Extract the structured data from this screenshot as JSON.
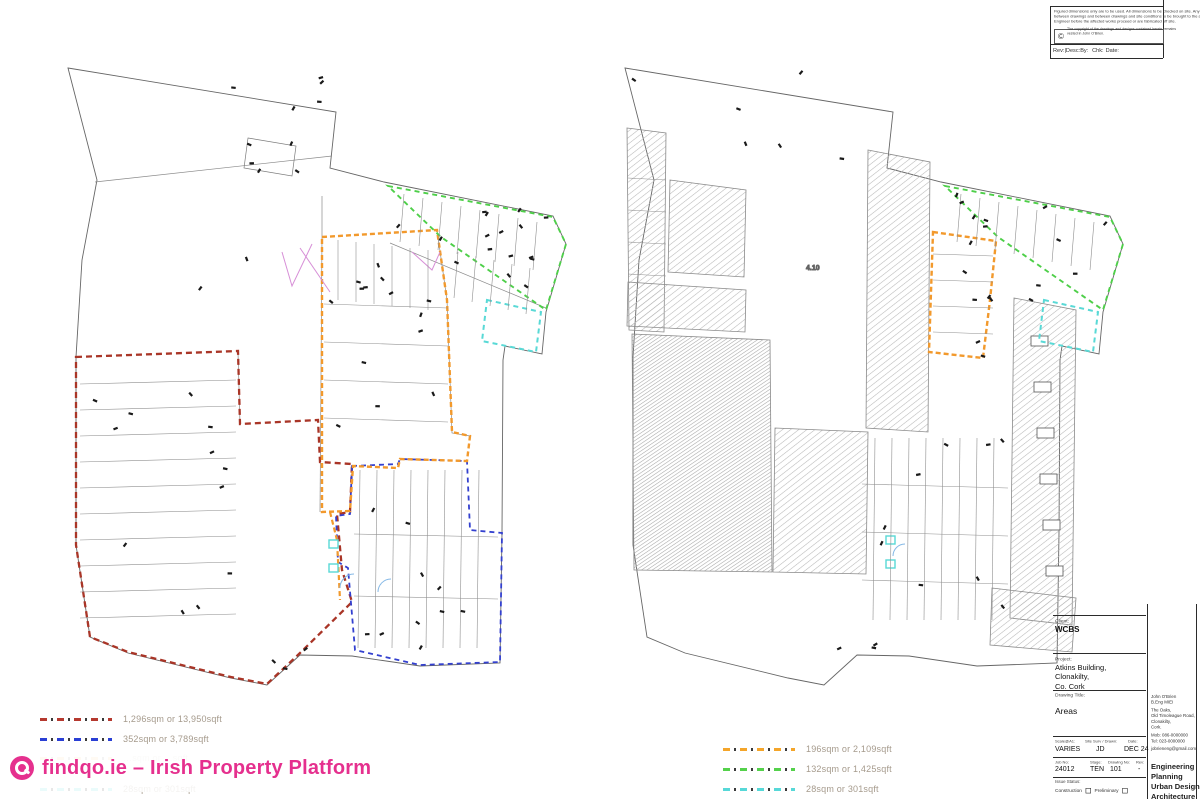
{
  "notes": {
    "disclaimer_lines": [
      "Figured dimensions only are to be used. All dimensions to be checked on site. Any discrepancy",
      "between drawings and between drawings and site conditions to be brought to the attention of the",
      "Engineer before the affected works proceed or are fabricated off site."
    ],
    "copyright_lines": [
      "The copyright of the drawings and designs contained herein remains",
      "vested in John O'Brien."
    ]
  },
  "revision_table": {
    "col_rev_desc": "Rev:|Desc:",
    "col_by": "By:",
    "col_chk": "Chk:",
    "col_date": "Date:"
  },
  "title_block": {
    "client_label": "Client:",
    "client": "WCBS",
    "project_label": "Project:",
    "project_lines": [
      "Atkins Building,",
      "Clonakilty,",
      "Co. Cork"
    ],
    "drawing_title_label": "Drawing Title:",
    "drawing_title": "Areas",
    "scale_label": "Scale@A1:",
    "scale_value": "VARIES",
    "drawn_label": "Site Surv / Drawn:",
    "drawn_value": "JD",
    "date_label": "Date:",
    "date_value": "DEC 24",
    "job_label": "Job No:",
    "job_value": "24012",
    "stage_label": "Stage:",
    "stage_value": "TEN",
    "drawing_no_label": "Drawing No:",
    "drawing_no_value": "101",
    "rev_label": "Rev:",
    "rev_value": "-",
    "issue_status_label": "Issue Status:",
    "issue_options": [
      "Construction",
      "Preliminary"
    ],
    "firm": {
      "contact_lines": [
        "John O'Brien",
        "B.Eng MIEI",
        "The Oaks,",
        "Old Timoleague Road,",
        "Clonakilty,",
        "Cork.",
        "Mob: 086-0000000",
        "Tel: 023-0000000",
        "jobrieneng@gmail.com"
      ],
      "services": [
        "Engineering",
        "Planning",
        "Urban Design",
        "Architecture"
      ]
    }
  },
  "legend_left": {
    "items": [
      {
        "color": "#b5392f",
        "label": "1,296sqm or 13,950sqft"
      },
      {
        "color": "#2a3fd4",
        "label": "352sqm or 3,789sqft"
      },
      {
        "color": "#f49b20",
        "label": "…sqm or …sqft",
        "obscured": true
      },
      {
        "color": "#57d8d8",
        "label": "28sqm or 301sqft"
      }
    ]
  },
  "legend_right": {
    "items": [
      {
        "color": "#f4a52a",
        "label": "196sqm or 2,109sqft"
      },
      {
        "color": "#54d14b",
        "label": "132sqm or 1,425sqft"
      },
      {
        "color": "#57d8d8",
        "label": "28sqm or 301sqft"
      }
    ]
  },
  "watermark": {
    "text": "findqo.ie – Irish Property Platform",
    "color": "#e5308e"
  },
  "plan_labels": {
    "room_label": "4.10"
  },
  "zones": {
    "red": "#a93527",
    "blue": "#3340cf",
    "orange": "#f2992c",
    "green": "#4ecf49",
    "cyan": "#59d9d6",
    "magenta": "#d78fd7"
  }
}
